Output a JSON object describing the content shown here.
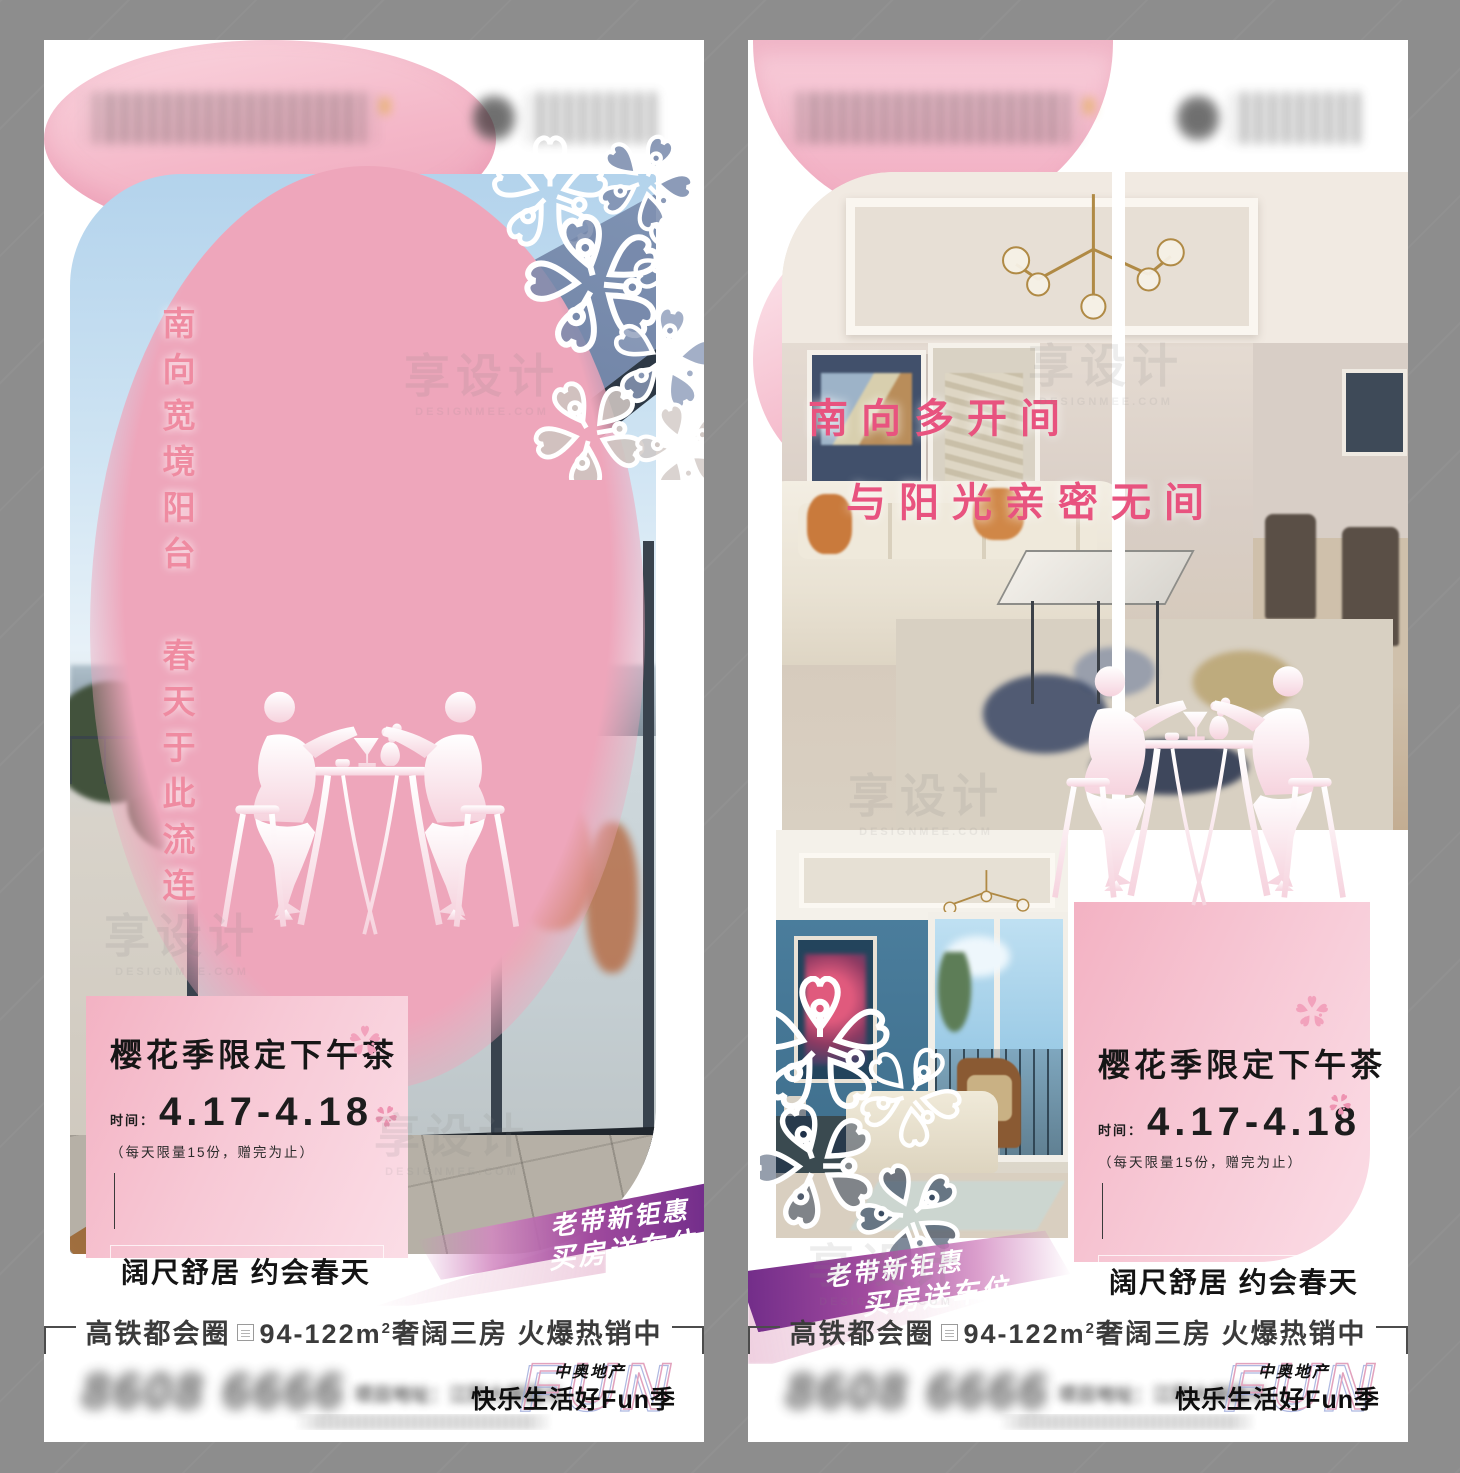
{
  "watermark": {
    "brand": "享设计",
    "domain": "DESIGNMEE.COM"
  },
  "shared": {
    "event": {
      "title": "樱花季限定下午茶",
      "time_label": "时间：",
      "date": "4.17-4.18",
      "note": "（每天限量15份，赠完为止）",
      "slogan": "阔尺舒居 约会春天"
    },
    "ribbon": {
      "line1": "老带新钜惠",
      "line2": "买房送车位"
    },
    "strip": {
      "part1": "高铁都会圈",
      "part2": "94-122m",
      "sup": "2",
      "part3": "奢阔三房 火爆热销中"
    },
    "footer": {
      "phone": "8608 6666",
      "address": "项目地址：江阴大岸路与……",
      "brand_top": "中奥地产",
      "brand_main": "快乐生活好Fun季",
      "fun_ghost": "FUN"
    },
    "colors": {
      "pink_headline_left": "#ef8ba1",
      "pink_headline_right": "#e8537f",
      "panel_pink": "#f5bccb",
      "ribbon_purple": "#6d2a88",
      "frame_gray": "#8d8d8d"
    }
  },
  "posters": [
    {
      "headline_col_right": "南向宽境阳台",
      "headline_col_left": "春天于此流连"
    },
    {
      "headline_line1": "南向多开间",
      "headline_line2": "与阳光亲密无间"
    }
  ]
}
